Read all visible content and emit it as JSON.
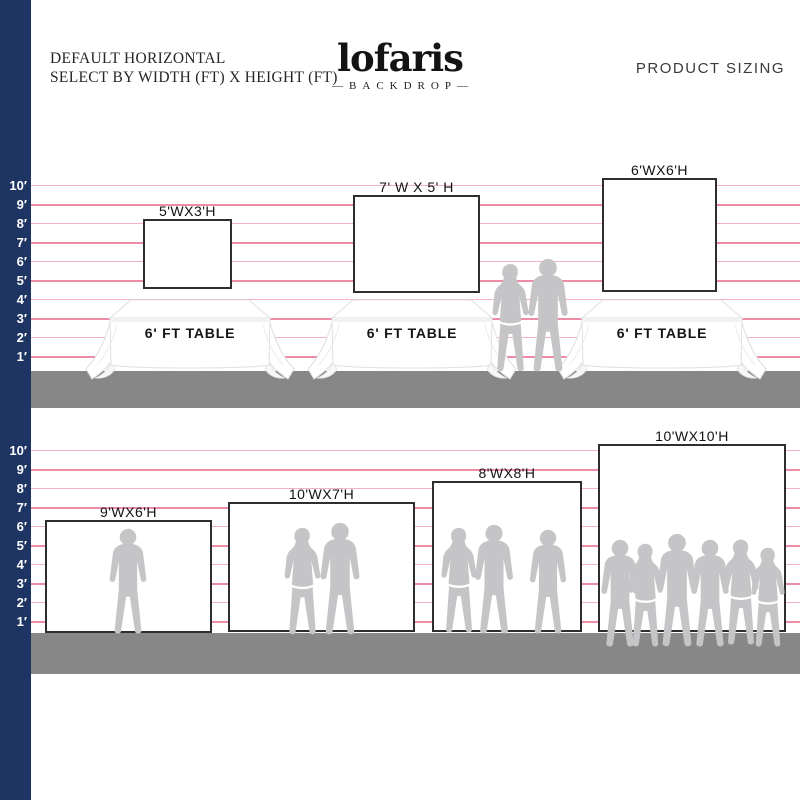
{
  "header": {
    "title_line1": "DEFAULT HORIZONTAL",
    "title_line2": "SELECT BY WIDTH (FT) X HEIGHT (FT)",
    "brand": "lofaris",
    "brand_sub": "—BACKDROP—",
    "right_title": "PRODUCT SIZING"
  },
  "ruler": {
    "labels": [
      "10′",
      "9′",
      "8′",
      "7′",
      "6′",
      "5′",
      "4′",
      "3′",
      "2′",
      "1′"
    ]
  },
  "sections": {
    "top": {
      "backdrops": [
        {
          "label": "5'WX3'H"
        },
        {
          "label": "7' W X 5' H"
        },
        {
          "label": "6'WX6'H"
        }
      ],
      "table_label": "6' FT TABLE"
    },
    "bottom": {
      "backdrops": [
        {
          "label": "9'WX6'H"
        },
        {
          "label": "10'WX7'H"
        },
        {
          "label": "8'WX8'H"
        },
        {
          "label": "10'WX10'H"
        }
      ]
    }
  },
  "colors": {
    "navy_bar": "#1e3462",
    "grid_pink_strong": "#ee8ca6",
    "grid_pink_pale": "#f4b3c3",
    "ground_gray": "#878787",
    "silhouette_gray": "#c5c5c8",
    "backdrop_border": "#2e2e2e"
  }
}
